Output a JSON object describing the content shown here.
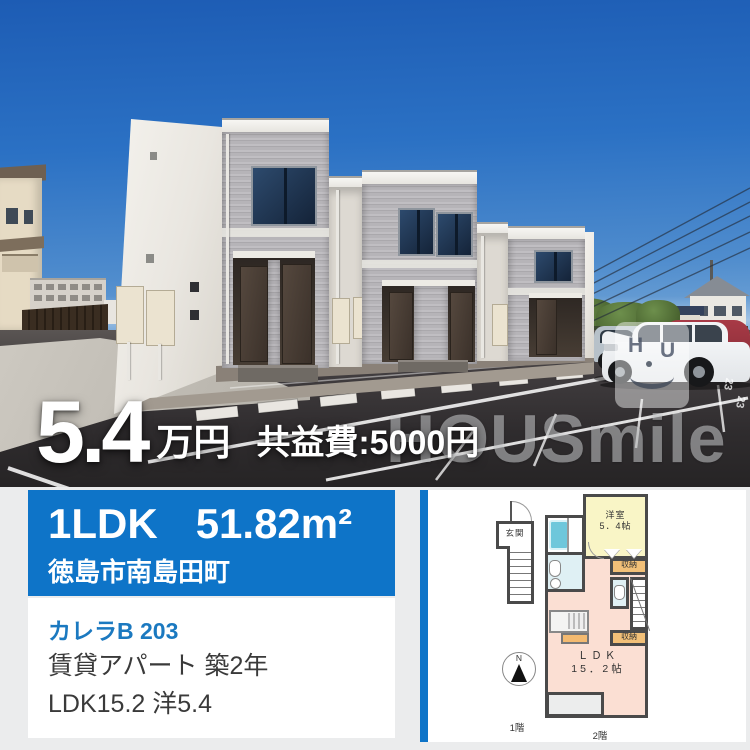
{
  "photo": {
    "price": {
      "value": "5.4",
      "unit": "万円",
      "fee": "共益費:5000円"
    },
    "watermark": {
      "brand": "HOUSmile",
      "logo_h": "H",
      "logo_u": "U"
    },
    "stall_number": "23"
  },
  "info": {
    "layout": "1LDK",
    "area": "51.82m²",
    "address": "徳島市南島田町",
    "name": "カレラB 203",
    "category": "賃貸アパート 築2年",
    "rooms": "LDK15.2 洋5.4"
  },
  "floorplan": {
    "genkan": "玄関",
    "west_room_name": "洋室",
    "west_room_size": "5．4帖",
    "closet1": "収納",
    "closet2": "収納",
    "ldk_name": "ＬＤＫ",
    "ldk_size": "15．2帖",
    "floor1": "1階",
    "floor2": "2階",
    "compass_n": "N"
  },
  "colors": {
    "accent": "#0e74c8",
    "name_blue": "#1b79c0"
  }
}
